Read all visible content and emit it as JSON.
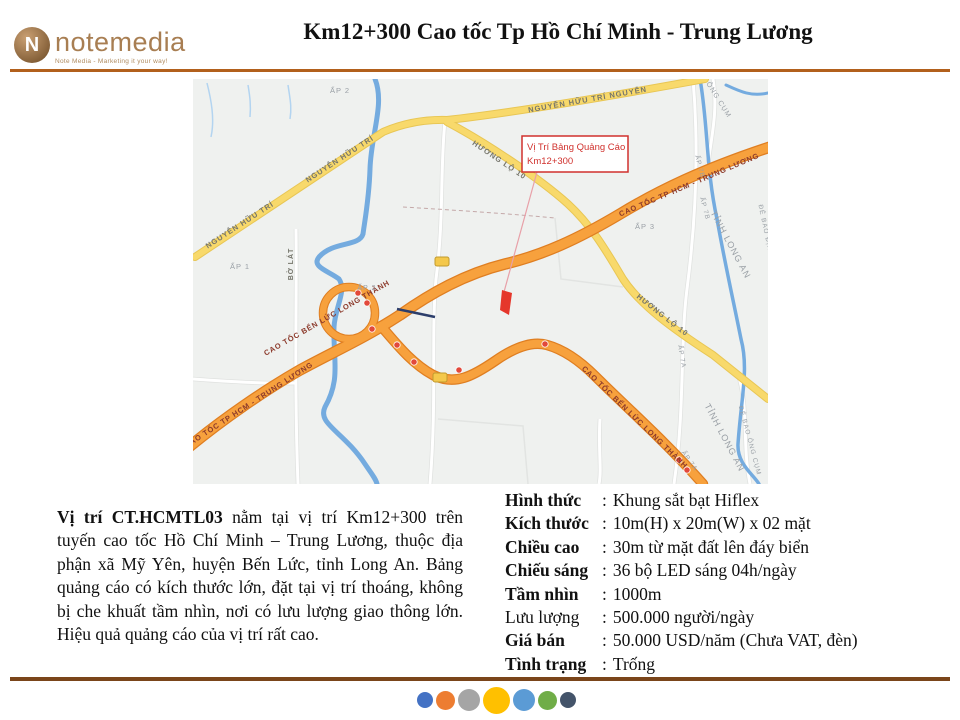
{
  "header": {
    "logo": {
      "brand": "notemedia",
      "monogram": "N",
      "tagline": "Note Media - Marketing it your way!"
    },
    "title": "Km12+300 Cao tốc Tp Hồ Chí Minh - Trung Lương"
  },
  "map": {
    "callout": {
      "line1": "Vị Trí Bảng Quảng Cáo",
      "line2": "Km12+300"
    },
    "roads": {
      "nguyen_huu_tri": "NGUYỄN HỮU TRÍ",
      "nguyen_huu_tri_top": "NGUYỄN HỮU TRÍ NGUYỄN",
      "huong_lo_10": "HƯƠNG LỘ 10",
      "cao_toc_hcm_trung_luong": "CAO TỐC TP HCM - TRUNG LƯƠNG",
      "cao_toc_ben_luc_long_thanh": "CAO TỐC BẾN LỨC LONG THÀNH",
      "bo_lat": "BỜ LÁT",
      "ong_cum": "ÔNG CỤM",
      "de_bao_dinh": "ĐÊ BAO ĐỊNH",
      "de_bao_ong_cum": "ĐÊ BAO ÔNG CỤM"
    },
    "areas": {
      "ap1": "ẤP 1",
      "ap2": "ẤP 2",
      "ap3": "ẤP 3",
      "ap7a": "ẤP 7A",
      "ap7b": "ẤP 7B",
      "tinh_long_an": "TỈNH LONG AN"
    }
  },
  "description": {
    "lead": "Vị trí CT.HCMTL03",
    "body": " nằm tại vị trí Km12+300 trên tuyến cao tốc Hồ Chí Minh – Trung Lương, thuộc địa phận xã Mỹ Yên, huyện Bến Lức, tỉnh Long An. Bảng quảng cáo có kích thước lớn, đặt tại vị trí thoáng, không bị che khuất tầm nhìn, nơi có lưu lượng giao thông lớn. Hiệu quả quảng cáo của vị trí rất cao."
  },
  "specs": {
    "colon": ":",
    "rows": [
      {
        "label": "Hình thức",
        "value": "Khung sắt bạt Hiflex"
      },
      {
        "label": "Kích thước",
        "value": "10m(H) x 20m(W) x 02 mặt"
      },
      {
        "label": "Chiều cao",
        "value": "30m từ mặt đất lên đáy biển"
      },
      {
        "label": "Chiếu sáng",
        "value": "36 bộ LED sáng 04h/ngày"
      },
      {
        "label": "Tầm nhìn",
        "value": "1000m"
      },
      {
        "label": "Lưu lượng",
        "value": "500.000 người/ngày"
      },
      {
        "label": "Giá bán",
        "value": "50.000 USD/năm (Chưa VAT, đèn)"
      },
      {
        "label": "Tình trạng",
        "value": "Trống"
      }
    ]
  },
  "footer": {
    "dot_colors": [
      "#4472C4",
      "#ED7D31",
      "#A5A5A5",
      "#FFC000",
      "#5B9BD5",
      "#70AD47",
      "#44546A"
    ]
  },
  "colors": {
    "header_rule": "#B2601C",
    "footer_rule": "#7A451A",
    "brand_bronze": "#A87E52",
    "highway_orange": "#F7A13D",
    "road_yellow": "#F8D96B",
    "river_blue": "#74ABDF",
    "callout_red": "#D0312D",
    "marker_red": "#E5372B"
  }
}
